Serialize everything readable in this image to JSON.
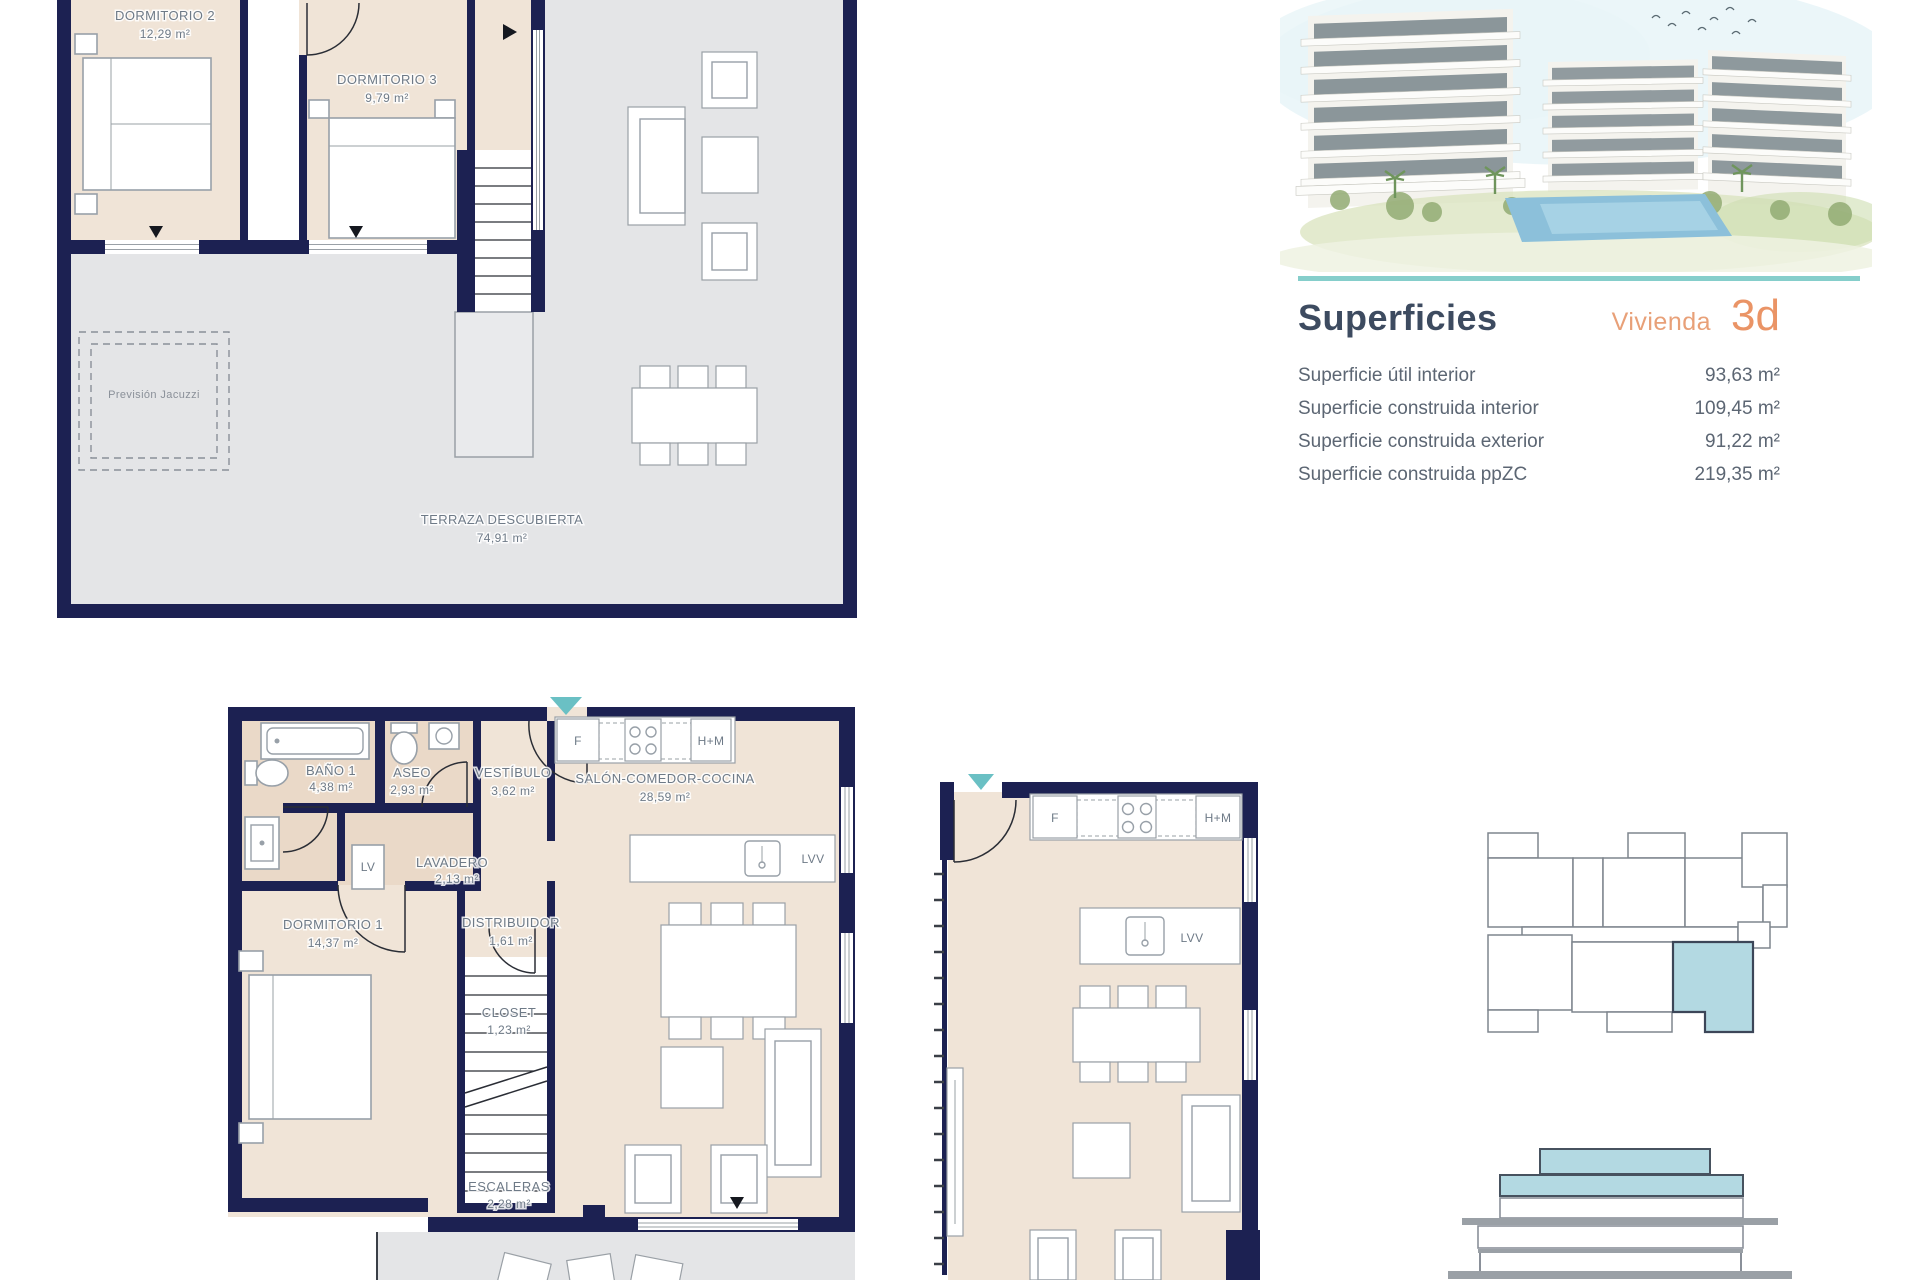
{
  "header": {
    "title": "Superficies",
    "unit_label": "Vivienda",
    "unit_code": "3d"
  },
  "surfaces": {
    "rows": [
      {
        "label": "Superficie útil interior",
        "value": "93,63 m²"
      },
      {
        "label": "Superficie construida interior",
        "value": "109,45 m²"
      },
      {
        "label": "Superficie construida exterior",
        "value": "91,22 m²"
      },
      {
        "label": "Superficie construida ppZC",
        "value": "219,35 m²"
      }
    ]
  },
  "upper_plan": {
    "dormitorio2": {
      "name": "DORMITORIO 2",
      "area": "12,29 m²"
    },
    "dormitorio3": {
      "name": "DORMITORIO 3",
      "area": "9,79 m²"
    },
    "terraza": {
      "name": "TERRAZA DESCUBIERTA",
      "area": "74,91 m²"
    },
    "jacuzzi": "Previsión Jacuzzi"
  },
  "main_plan": {
    "bano1": {
      "name": "BAÑO 1",
      "area": "4,38 m²"
    },
    "aseo": {
      "name": "ASEO",
      "area": "2,93 m²"
    },
    "vestibulo": {
      "name": "VESTÍBULO",
      "area": "3,62 m²"
    },
    "salon": {
      "name": "SALÓN-COMEDOR-COCINA",
      "area": "28,59 m²"
    },
    "lavadero": {
      "name": "LAVADERO",
      "area": "2,13 m²"
    },
    "dormitorio1": {
      "name": "DORMITORIO 1",
      "area": "14,37 m²"
    },
    "distribuidor": {
      "name": "DISTRIBUIDOR",
      "area": "1,61 m²"
    },
    "closet": {
      "name": "CLOSET",
      "area": "1,23 m²"
    },
    "escaleras": {
      "name": "ESCALERAS",
      "area": "2,28 m²"
    }
  },
  "appliances": {
    "f": "F",
    "hm": "H+M",
    "lv": "LV",
    "lvv": "LVV"
  },
  "colors": {
    "wall_navy": "#1c2152",
    "floor_interior": "#f0e4d7",
    "floor_wet": "#ead9c8",
    "floor_terrace": "#e4e5e7",
    "accent_teal": "#85cecb",
    "entry_teal": "#6ac0c4",
    "title_navy": "#3d4b60",
    "unit_orange": "#ea9466",
    "keyplan_highlight": "#b3d9e2",
    "label_gray": "#6e7a87"
  }
}
